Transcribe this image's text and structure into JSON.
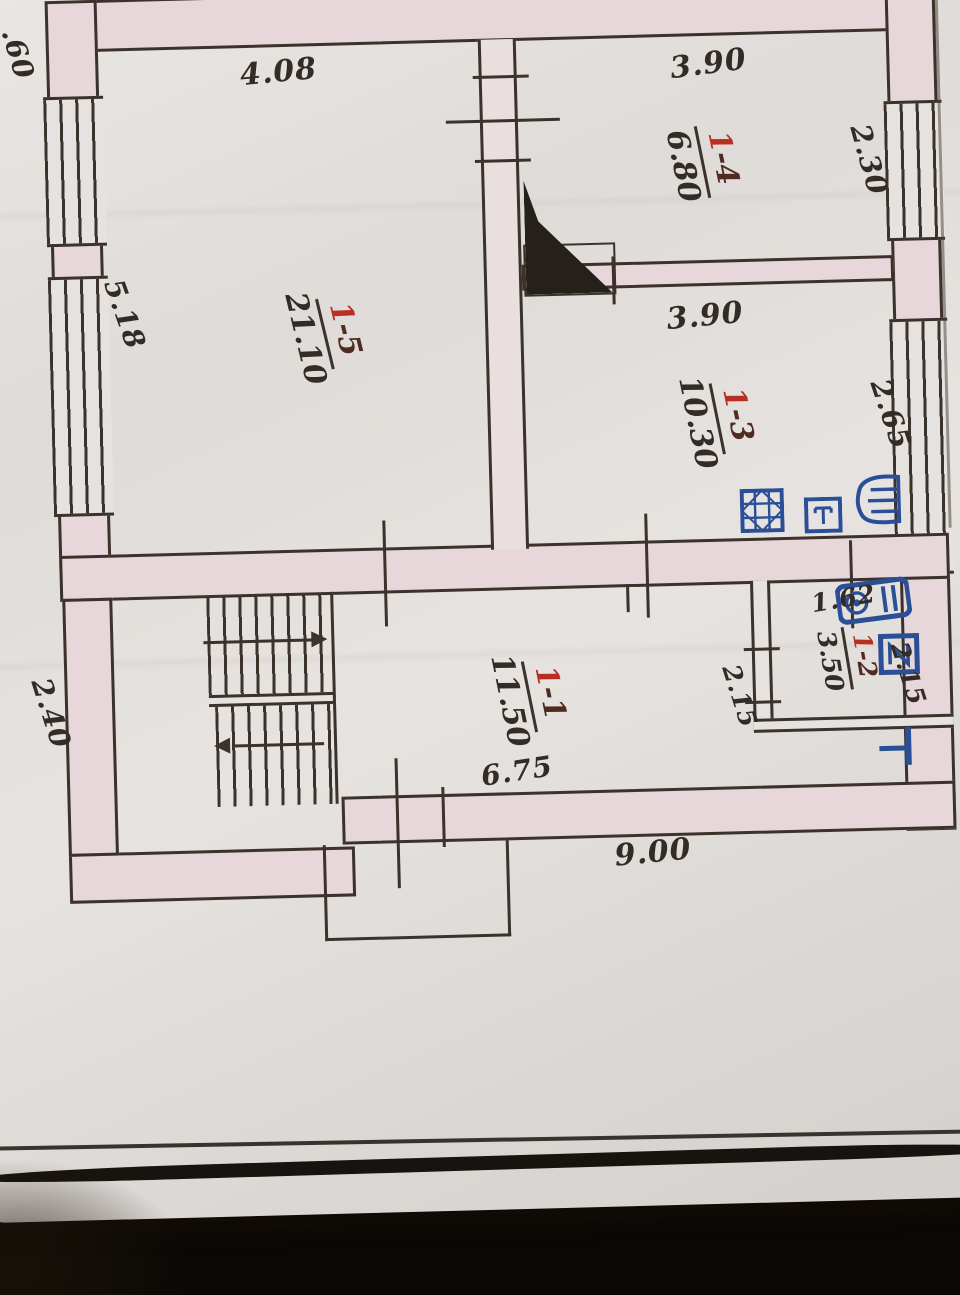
{
  "rooms": [
    {
      "id": "1-1",
      "prefix": "1",
      "suffix": "-1",
      "area": "11.50"
    },
    {
      "id": "1-2",
      "prefix": "1",
      "suffix": "-2",
      "area": "3.50"
    },
    {
      "id": "1-3",
      "prefix": "1",
      "suffix": "-3",
      "area": "10.30"
    },
    {
      "id": "1-4",
      "prefix": "1",
      "suffix": "-4",
      "area": "6.80"
    },
    {
      "id": "1-5",
      "prefix": "1",
      "suffix": "-5",
      "area": "21.10"
    }
  ],
  "dimensions": {
    "left_top_partial": ".60",
    "top_left": "4.08",
    "top_right": "3.90",
    "right_upper": "2.30",
    "kitchen_width": "3.90",
    "right_middle": "2.65",
    "left_height": "5.18",
    "bath_width": "1.62",
    "bath_height_left": "2.15",
    "bath_height_right": "2.15",
    "room11_width": "6.75",
    "bottom_width": "9.00",
    "stair_height": "2.40"
  },
  "fixtures": {
    "kitchen": [
      "stove-icon",
      "table-icon",
      "kitchen-radiator-icon"
    ],
    "bathroom": [
      "washing-machine-icon",
      "sink-icon",
      "towel-rail-icon"
    ],
    "other": [
      "chimney-flue-icon",
      "staircase-up-arrow",
      "staircase-down-arrow"
    ]
  },
  "colors": {
    "ink": "#3a322b",
    "room_number_red": "#b92e22",
    "pen_blue": "#2b4f97",
    "wall_fill": "#e7d7da",
    "paper": "#e3e0dd",
    "cardboard": "#c9a76a",
    "bottom_band": "#17130e"
  }
}
